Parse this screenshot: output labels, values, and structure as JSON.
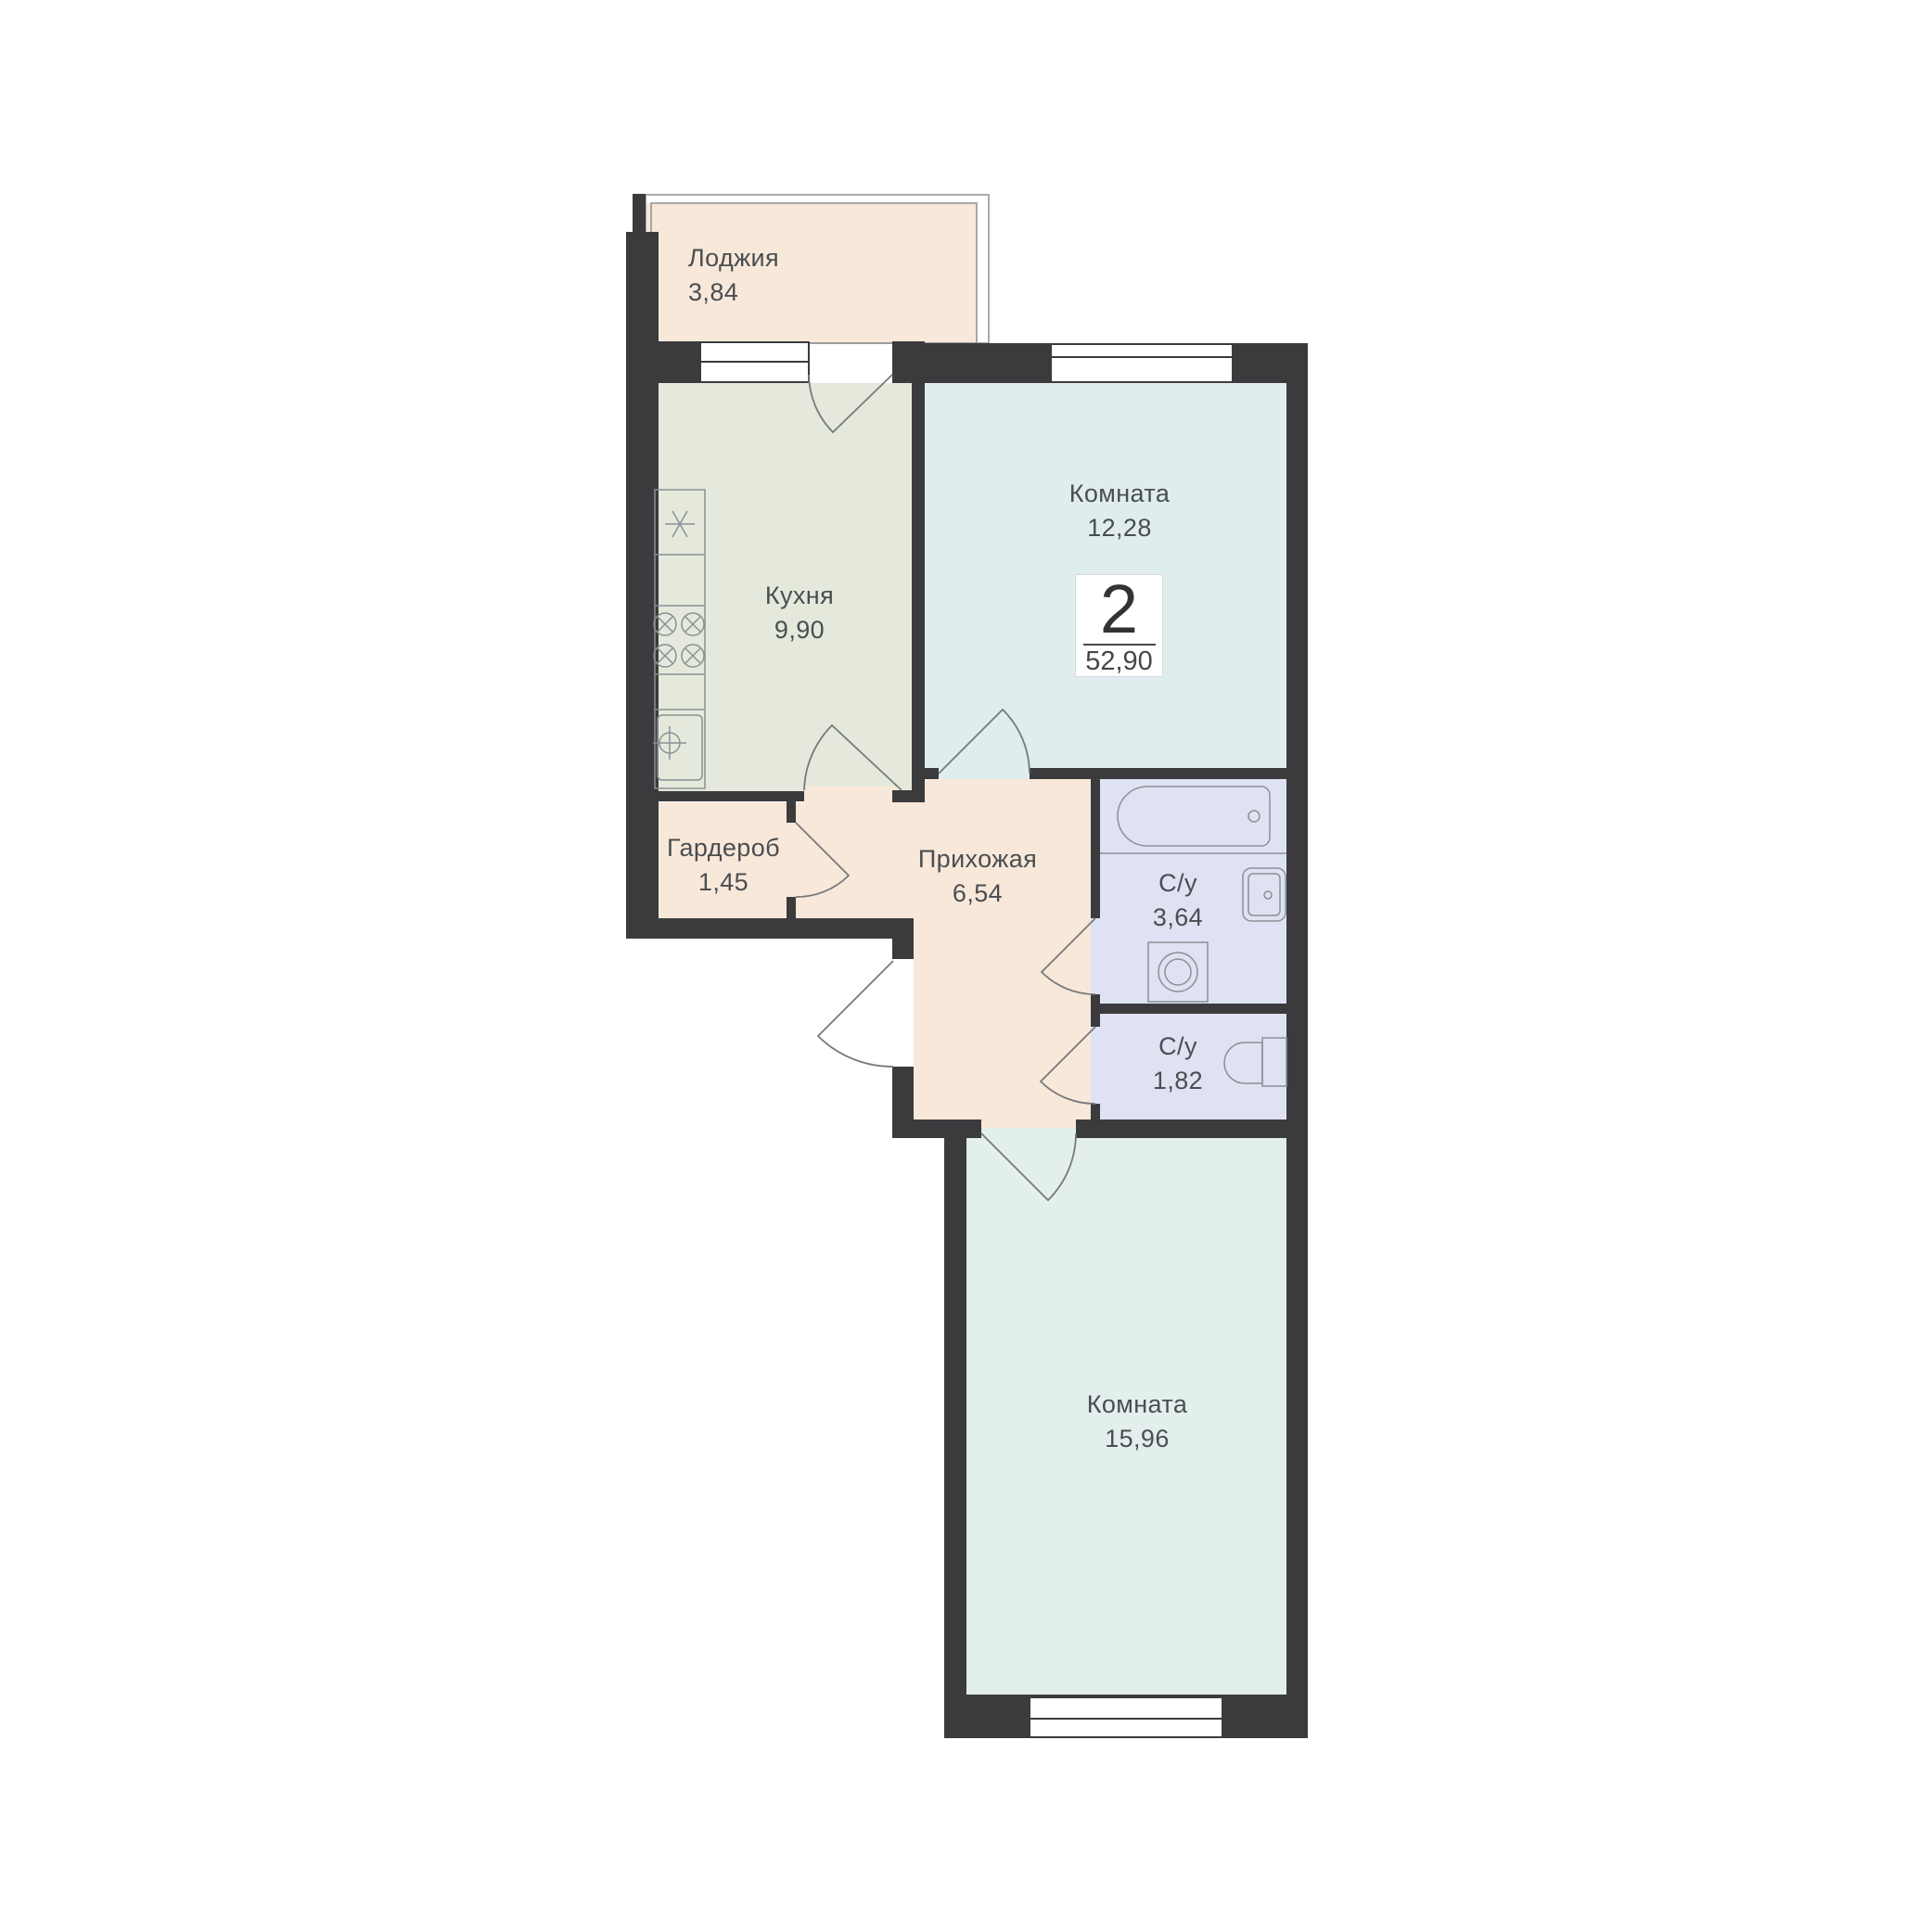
{
  "rooms": [
    {
      "name": "Лоджия",
      "area": "3,84"
    },
    {
      "name": "Кухня",
      "area": "9,90"
    },
    {
      "name": "Комната",
      "area": "12,28"
    },
    {
      "name": "Гардероб",
      "area": "1,45"
    },
    {
      "name": "Прихожая",
      "area": "6,54"
    },
    {
      "name": "С/у",
      "area": "3,64"
    },
    {
      "name": "С/у",
      "area": "1,82"
    },
    {
      "name": "Комната",
      "area": "15,96"
    }
  ],
  "badge": {
    "rooms_count": "2",
    "total_area": "52,90"
  },
  "colors": {
    "wall": "#3b3b3d",
    "hall_loggia_fill": "#f8e8da",
    "kitchen_fill": "#e4e9dc",
    "room_12_fill": "#e0edee",
    "room_15_fill": "#e2efec",
    "bathroom_fill": "#dfe2f2",
    "door_line": "#77797b",
    "furniture_line": "#8c9094",
    "label_text": "#4a4e51",
    "badge_border": "#d9d9d9"
  }
}
